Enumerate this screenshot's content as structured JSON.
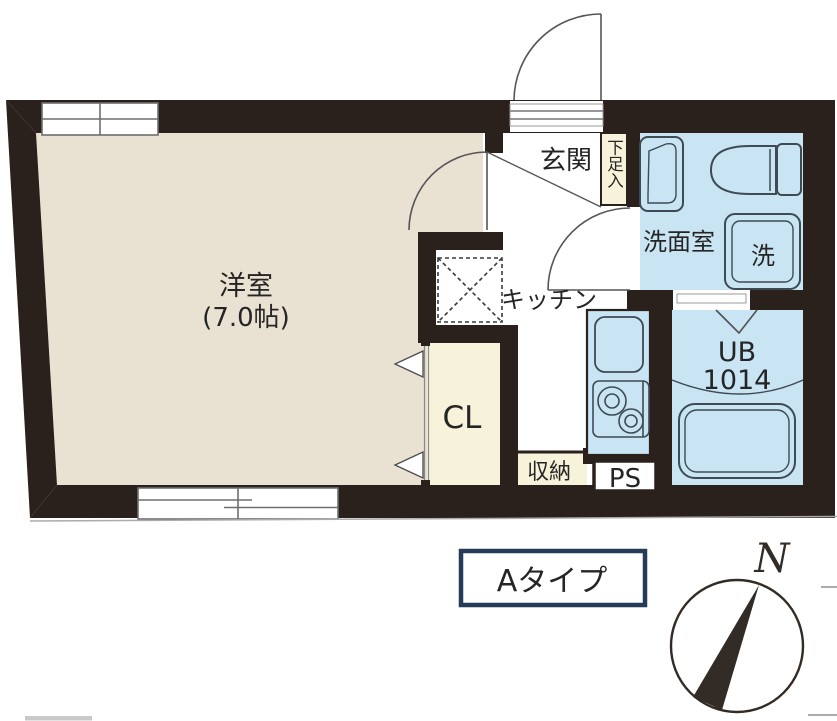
{
  "plan": {
    "rooms": {
      "main_room": {
        "name": "洋室",
        "size": "(7.0帖)"
      },
      "entrance": {
        "label": "玄関"
      },
      "kitchen": {
        "label": "キッチン"
      },
      "washroom": {
        "label": "洗面室"
      },
      "unit_bath": {
        "label": "UB",
        "size": "1014"
      },
      "closet": {
        "label": "CL"
      },
      "storage": {
        "label": "収納"
      },
      "pipe_space": {
        "label": "PS"
      }
    },
    "fixtures": {
      "washer_label": "洗",
      "shoe_cabinet_label": "下足入"
    },
    "type_label": "Aタイプ",
    "compass": {
      "north": "N"
    },
    "colors": {
      "wall": "#2b211c",
      "room_floor": "#e9e1d2",
      "wet_area": "#c9e4f3",
      "storage_fill": "#f7f3da",
      "outline": "#3e4b55",
      "door_line": "#555555",
      "window_line": "#6e6e6e",
      "text": "#252525",
      "type_box_border": "#263b58",
      "compass_ink": "#332b26",
      "artifact": "#ababab"
    }
  }
}
